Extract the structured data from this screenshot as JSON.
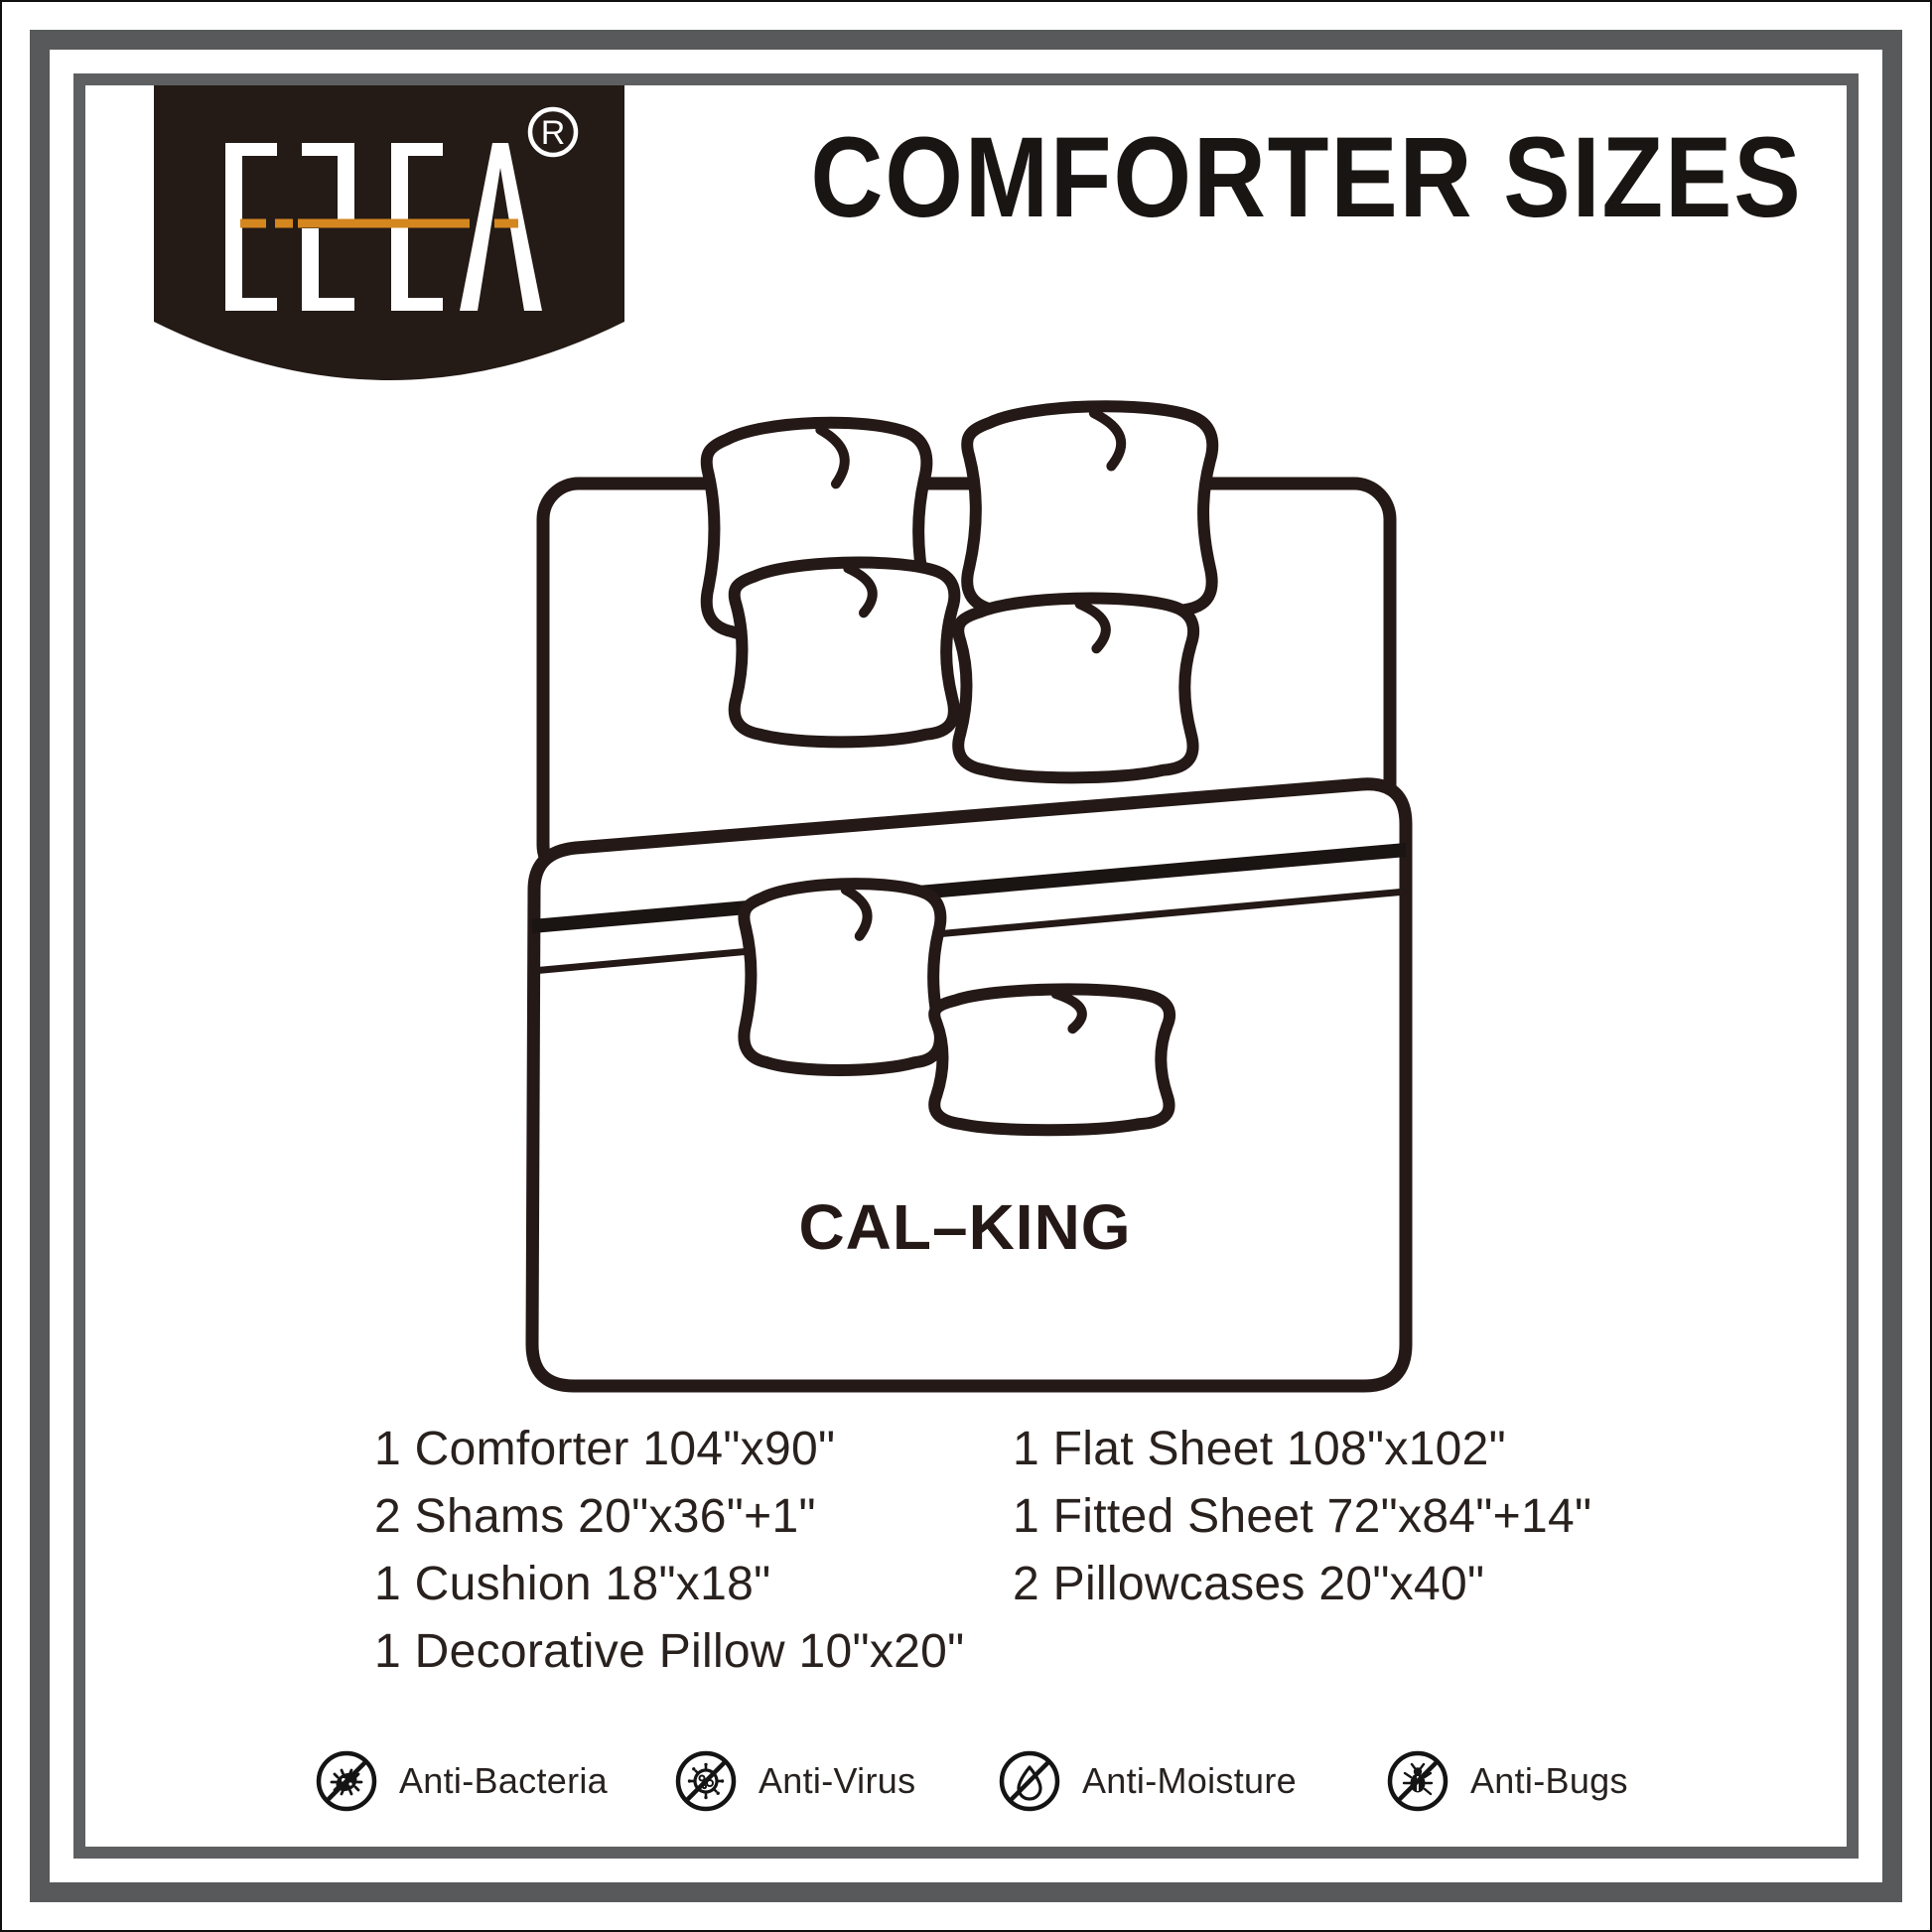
{
  "brand": {
    "wordmark": "ESCA",
    "registered_letter": "R"
  },
  "header": {
    "title": "COMFORTER SIZES"
  },
  "diagram": {
    "size_label": "CAL–KING"
  },
  "specs": {
    "left": [
      "1 Comforter 104\"x90\"",
      "2 Shams 20\"x36\"+1\"",
      "1 Cushion 18\"x18\"",
      "1 Decorative Pillow 10\"x20\""
    ],
    "right": [
      "1 Flat Sheet 108\"x102\"",
      "1 Fitted Sheet 72\"x84\"+14\"",
      "2 Pillowcases 20\"x40\""
    ]
  },
  "badges": [
    {
      "icon": "anti-bacteria-icon",
      "label": "Anti-Bacteria"
    },
    {
      "icon": "anti-virus-icon",
      "label": "Anti-Virus"
    },
    {
      "icon": "anti-moisture-icon",
      "label": "Anti-Moisture"
    },
    {
      "icon": "anti-bugs-icon",
      "label": "Anti-Bugs"
    }
  ],
  "colors": {
    "frame_gray": "#58595b",
    "badge_brown": "#241a16",
    "accent_orange": "#d4861f",
    "ink": "#241916"
  }
}
